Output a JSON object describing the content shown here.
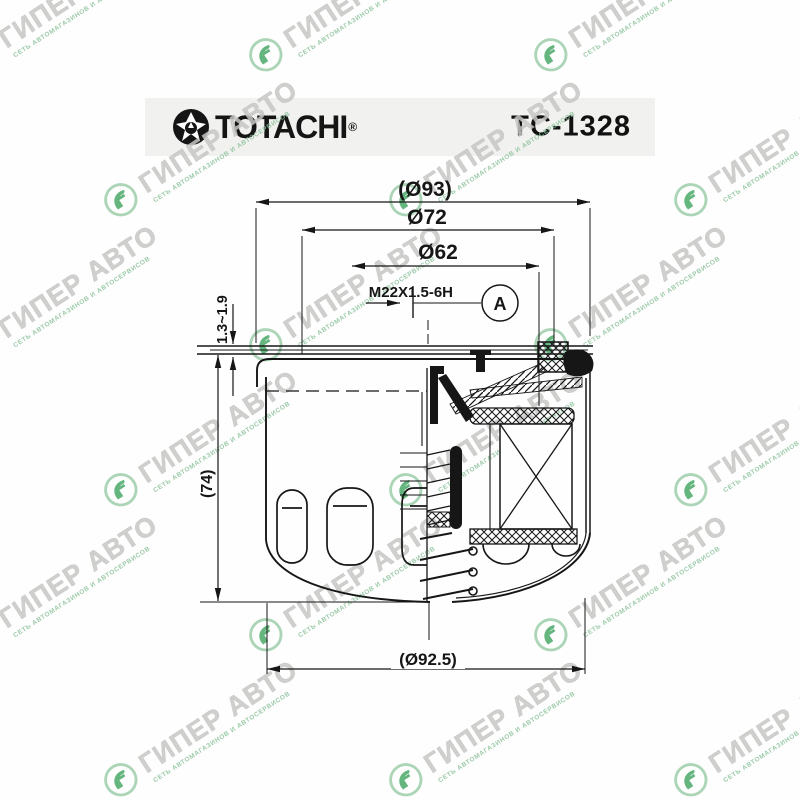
{
  "header": {
    "brand": "TOTACHI",
    "reg_mark": "®",
    "part_number": "TC-1328"
  },
  "watermark": {
    "text": "ГИПЕР АВТО",
    "subtext": "СЕТЬ АВТОМАГАЗИНОВ И АВТОСЕРВИСОВ"
  },
  "drawing": {
    "labels": {
      "d93": "(Ø93)",
      "d72": "Ø72",
      "d62": "Ø62",
      "thread": "M22X1.5-6H",
      "balloon": "A",
      "thickness": "1.3~1.9",
      "height": "(74)",
      "d925": "(Ø92.5)"
    },
    "colors": {
      "line": "#161616",
      "header_bar": "#f1f1ef",
      "watermark_gray": "#c7c7c5",
      "watermark_green": "#3fa45f"
    }
  }
}
